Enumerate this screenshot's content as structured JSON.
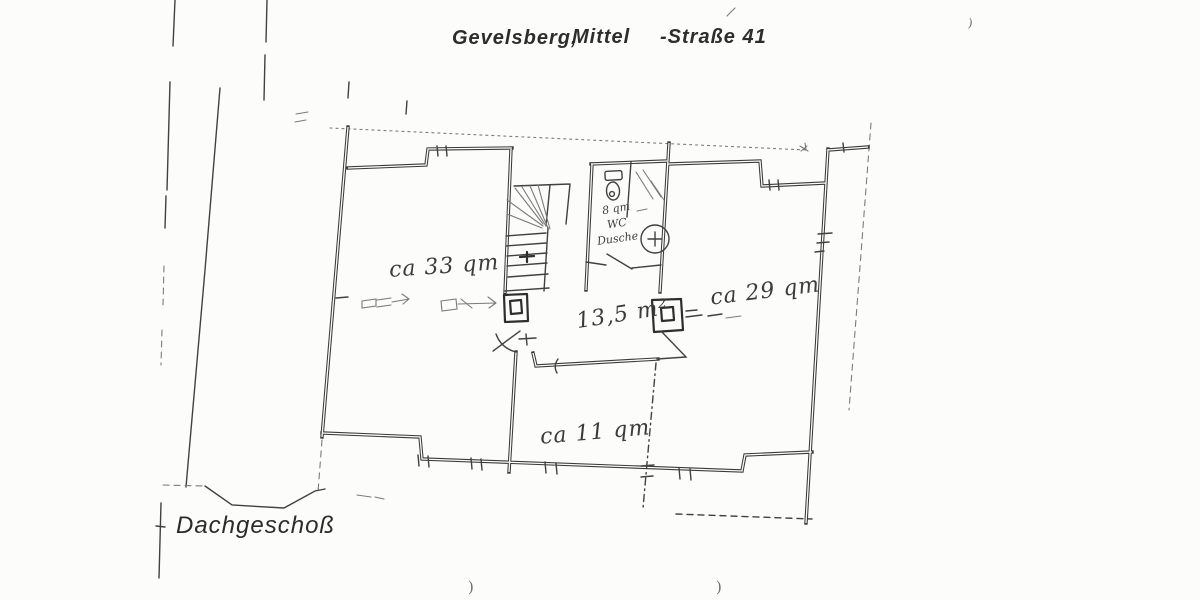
{
  "document": {
    "title_city": "Gevelsberg,",
    "title_street": "Mittel",
    "title_number": "-Straße 41",
    "floor_label": "Dachgeschoß"
  },
  "rooms": {
    "left_area": "ca 33 qm",
    "right_area": "ca 29 qm",
    "hall_area": "13,5 m²",
    "bottom_area": "ca 11 qm"
  },
  "bathroom": {
    "area": "8 qm",
    "wc": "WC",
    "shower": "Dusche"
  },
  "scan_marks": {
    "bottom_left": ")",
    "bottom_right": ")",
    "top_right": ")"
  },
  "colors": {
    "ink": "#3a3a3a",
    "paper": "#fcfcfb"
  }
}
